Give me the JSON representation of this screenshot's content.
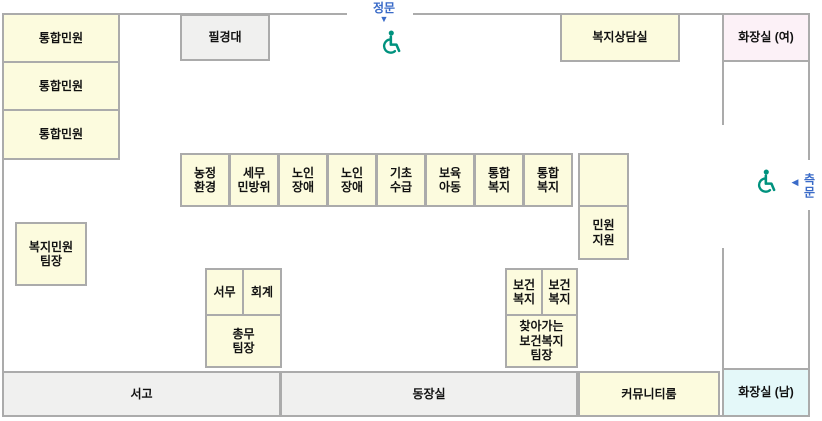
{
  "colors": {
    "room_yellow": "#fcfbde",
    "room_gray": "#f0f0ef",
    "room_pink": "#fcf1f7",
    "room_cyan": "#e4f8f9",
    "wall_gray": "#ababab",
    "gate_blue": "#3a6bc8",
    "accessible_teal": "#00927e",
    "label_text": "#111111"
  },
  "gates": {
    "main": {
      "label": "정문",
      "arrow": "▼"
    },
    "side": {
      "label": "측문",
      "arrow": "◀"
    }
  },
  "icons": {
    "main_gate_accessible": "wheelchair-symbol",
    "side_gate_accessible": "wheelchair-symbol"
  },
  "rooms": {
    "counter1": {
      "label": "통합민원"
    },
    "counter2": {
      "label": "통합민원"
    },
    "counter3": {
      "label": "통합민원"
    },
    "writing_desk": {
      "label": "필경대"
    },
    "welfare_consult": {
      "label": "복지상담실"
    },
    "restroom_women": {
      "label": "화장실 (여)"
    },
    "desk_agri_env": {
      "label": "농정\n환경"
    },
    "desk_tax_civil": {
      "label": "세무\n민방위"
    },
    "desk_senior_disabled1": {
      "label": "노인\n장애"
    },
    "desk_senior_disabled2": {
      "label": "노인\n장애"
    },
    "desk_basic_benefit": {
      "label": "기초\n수급"
    },
    "desk_childcare": {
      "label": "보육\n아동"
    },
    "desk_integrated_welfare1": {
      "label": "통합\n복지"
    },
    "desk_integrated_welfare2": {
      "label": "통합\n복지"
    },
    "desk_empty": {
      "label": ""
    },
    "desk_minwon_support": {
      "label": "민원\n지원"
    },
    "welfare_team_leader": {
      "label": "복지민원\n팀장"
    },
    "desk_general_affairs": {
      "label": "서무"
    },
    "desk_accounting": {
      "label": "회계"
    },
    "general_team_leader": {
      "label": "총무\n팀장"
    },
    "desk_health_welfare1": {
      "label": "보건\n복지"
    },
    "desk_health_welfare2": {
      "label": "보건\n복지"
    },
    "visiting_health_team_leader": {
      "label": "찾아가는\n보건복지\n팀장"
    },
    "archive": {
      "label": "서고"
    },
    "chief_office": {
      "label": "동장실"
    },
    "community_room": {
      "label": "커뮤니티룸"
    },
    "restroom_men": {
      "label": "화장실 (남)"
    }
  }
}
